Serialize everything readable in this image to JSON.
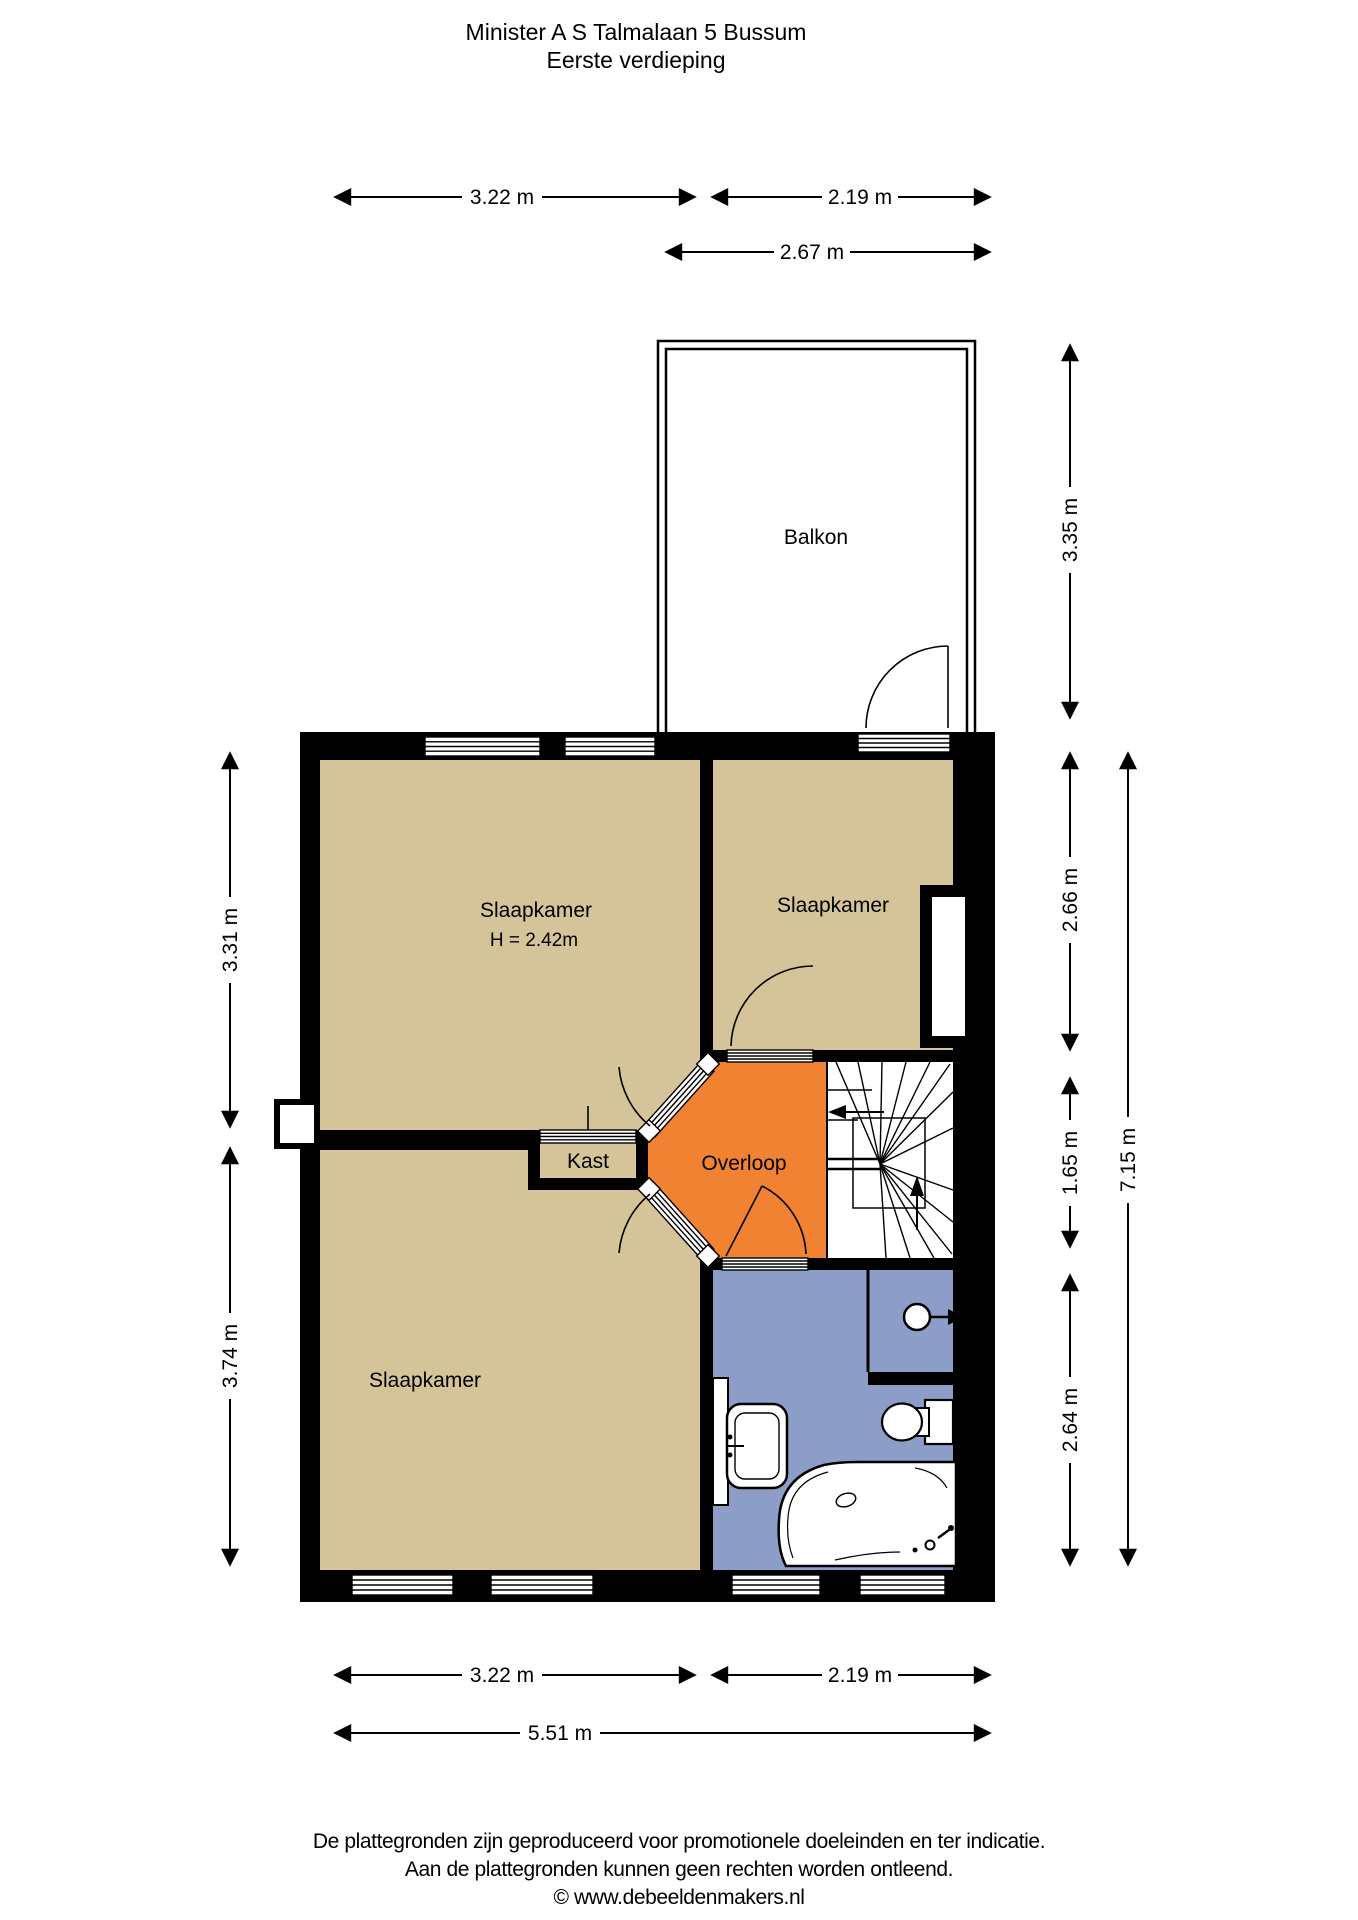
{
  "title": {
    "address": "Minister A S Talmalaan 5 Bussum",
    "floor": "Eerste verdieping"
  },
  "rooms": {
    "balkon": {
      "label": "Balkon"
    },
    "slaapkamer_top_left": {
      "label": "Slaapkamer",
      "height_note": "H = 2.42m"
    },
    "slaapkamer_top_right": {
      "label": "Slaapkamer"
    },
    "slaapkamer_bottom_left": {
      "label": "Slaapkamer"
    },
    "kast": {
      "label": "Kast"
    },
    "overloop": {
      "label": "Overloop"
    }
  },
  "dimensions": {
    "top_width_left": "3.22 m",
    "top_width_right": "2.19 m",
    "balcony_width": "2.67 m",
    "balcony_depth": "3.35 m",
    "right_top": "2.66 m",
    "right_middle": "1.65 m",
    "right_bottom": "2.64 m",
    "right_total": "7.15 m",
    "left_top": "3.31 m",
    "left_bottom": "3.74 m",
    "bottom_width_left": "3.22 m",
    "bottom_width_right": "2.19 m",
    "bottom_total": "5.51 m"
  },
  "colors": {
    "bedroom": "#d5c499",
    "hallway_orange": "#f08232",
    "bathroom_blue": "#8c9ec8",
    "wall": "#000000"
  },
  "footer": {
    "line1": "De plattegronden zijn geproduceerd voor promotionele doeleinden en ter indicatie.",
    "line2": "Aan de plattegronden kunnen geen rechten worden ontleend.",
    "line3": "© www.debeeldenmakers.nl"
  }
}
